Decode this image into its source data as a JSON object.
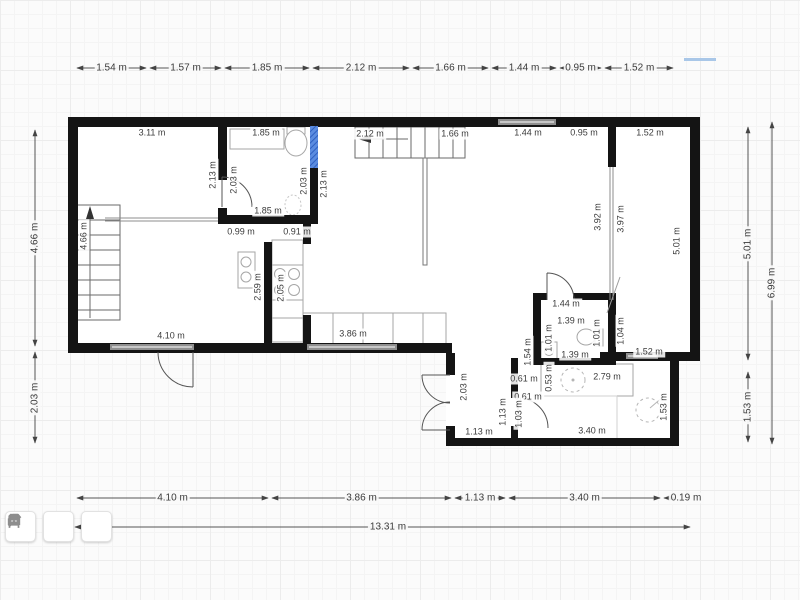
{
  "colors": {
    "wall": "#141414",
    "selection_hatch": "#2e5fc0",
    "window": "#8f8f8f",
    "dim_line": "#555555",
    "highlight_blue": "#a9c7e8",
    "background": "#fbfbfb"
  },
  "toolbar": {
    "buttons": [
      {
        "name": "build-tool",
        "icon": "hammer-icon"
      },
      {
        "name": "surfaces-tool",
        "icon": "panel-icon"
      },
      {
        "name": "furniture-tool",
        "icon": "armchair-icon"
      }
    ]
  },
  "dimensions": {
    "top": {
      "y": 68,
      "segments": [
        {
          "label": "1.54 m",
          "a": 75,
          "b": 148
        },
        {
          "label": "1.57 m",
          "a": 148,
          "b": 223
        },
        {
          "label": "1.85 m",
          "a": 223,
          "b": 311
        },
        {
          "label": "2.12 m",
          "a": 311,
          "b": 411
        },
        {
          "label": "1.66 m",
          "a": 411,
          "b": 490
        },
        {
          "label": "1.44 m",
          "a": 490,
          "b": 558
        },
        {
          "label": "0.95 m",
          "a": 558,
          "b": 603
        },
        {
          "label": "1.52 m",
          "a": 603,
          "b": 675
        }
      ]
    },
    "bottom": {
      "y": 498,
      "segments": [
        {
          "label": "4.10 m",
          "a": 75,
          "b": 270
        },
        {
          "label": "3.86 m",
          "a": 270,
          "b": 453
        },
        {
          "label": "1.13 m",
          "a": 453,
          "b": 507
        },
        {
          "label": "3.40 m",
          "a": 507,
          "b": 662
        },
        {
          "label": "0.19 m",
          "a": 662,
          "b": 677,
          "la": 686
        }
      ]
    },
    "bottom_total": {
      "y": 527,
      "a": 75,
      "b": 690,
      "label": "13.31 m",
      "la": 388
    },
    "left": {
      "x": 35,
      "segments": [
        {
          "label": "4.66 m",
          "a": 128,
          "b": 348
        },
        {
          "label": "2.03 m",
          "a": 350,
          "b": 445
        }
      ]
    },
    "right_inner": {
      "x": 748,
      "segments": [
        {
          "label": "5.01 m",
          "a": 125,
          "b": 362
        },
        {
          "label": "1.53 m",
          "a": 370,
          "b": 444
        }
      ]
    },
    "right_outer": {
      "x": 772,
      "segments": [
        {
          "label": "6.99 m",
          "a": 120,
          "b": 446
        }
      ]
    }
  },
  "plan_labels": [
    {
      "t": "3.11 m",
      "x": 152,
      "y": 133
    },
    {
      "t": "1.85 m",
      "x": 266,
      "y": 133
    },
    {
      "t": "2.12 m",
      "x": 370,
      "y": 134
    },
    {
      "t": "1.66 m",
      "x": 455,
      "y": 134
    },
    {
      "t": "1.44 m",
      "x": 528,
      "y": 133
    },
    {
      "t": "0.95 m",
      "x": 584,
      "y": 133
    },
    {
      "t": "1.52 m",
      "x": 650,
      "y": 133
    },
    {
      "t": "2.13 m",
      "x": 213,
      "y": 175,
      "v": 1
    },
    {
      "t": "2.03 m",
      "x": 234,
      "y": 180,
      "v": 1
    },
    {
      "t": "2.03 m",
      "x": 304,
      "y": 181,
      "v": 1
    },
    {
      "t": "2.13 m",
      "x": 324,
      "y": 184,
      "v": 1
    },
    {
      "t": "1.85 m",
      "x": 268,
      "y": 211
    },
    {
      "t": "0.99 m",
      "x": 241,
      "y": 232
    },
    {
      "t": "0.91 m",
      "x": 297,
      "y": 232
    },
    {
      "t": "4.66 m",
      "x": 84,
      "y": 236,
      "v": 1
    },
    {
      "t": "2.59 m",
      "x": 258,
      "y": 287,
      "v": 1
    },
    {
      "t": "2.05 m",
      "x": 281,
      "y": 288,
      "v": 1
    },
    {
      "t": "3.92 m",
      "x": 598,
      "y": 217,
      "v": 1
    },
    {
      "t": "3.97 m",
      "x": 621,
      "y": 219,
      "v": 1
    },
    {
      "t": "5.01 m",
      "x": 677,
      "y": 241,
      "v": 1
    },
    {
      "t": "4.10 m",
      "x": 171,
      "y": 336
    },
    {
      "t": "3.86 m",
      "x": 353,
      "y": 334
    },
    {
      "t": "1.44 m",
      "x": 566,
      "y": 304
    },
    {
      "t": "1.39 m",
      "x": 571,
      "y": 321
    },
    {
      "t": "1.01 m",
      "x": 549,
      "y": 338,
      "v": 1
    },
    {
      "t": "1.01 m",
      "x": 597,
      "y": 333,
      "v": 1
    },
    {
      "t": "1.04 m",
      "x": 621,
      "y": 331,
      "v": 1
    },
    {
      "t": "1.54 m",
      "x": 528,
      "y": 352,
      "v": 1
    },
    {
      "t": "1.39 m",
      "x": 575,
      "y": 355
    },
    {
      "t": "1.52 m",
      "x": 649,
      "y": 352
    },
    {
      "t": "0.61 m",
      "x": 524,
      "y": 379
    },
    {
      "t": "0.53 m",
      "x": 549,
      "y": 378,
      "v": 1
    },
    {
      "t": "2.79 m",
      "x": 607,
      "y": 377
    },
    {
      "t": "0.61 m",
      "x": 528,
      "y": 397
    },
    {
      "t": "1.03 m",
      "x": 519,
      "y": 414,
      "v": 1
    },
    {
      "t": "1.13 m",
      "x": 503,
      "y": 412,
      "v": 1
    },
    {
      "t": "2.03 m",
      "x": 464,
      "y": 387,
      "v": 1
    },
    {
      "t": "1.13 m",
      "x": 479,
      "y": 432
    },
    {
      "t": "3.40 m",
      "x": 592,
      "y": 431
    },
    {
      "t": "1.53 m",
      "x": 664,
      "y": 407,
      "v": 1
    }
  ]
}
